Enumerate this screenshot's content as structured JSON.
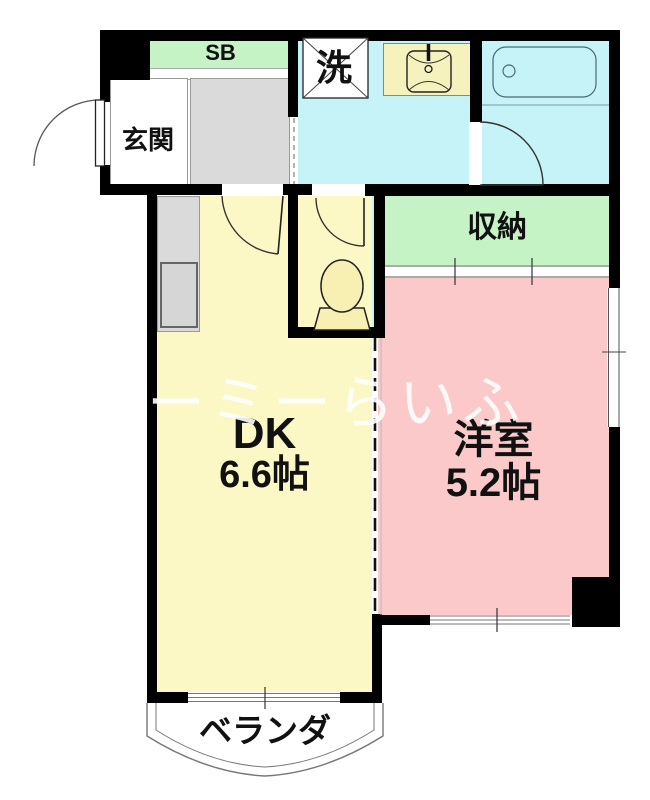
{
  "colors": {
    "wall": "#000000",
    "yellow": "#FBF8C5",
    "pink": "#FBC9C9",
    "cyan": "#C6F3F8",
    "green": "#C6F3C6",
    "gray": "#DADADA",
    "vanity": "#F6F2BE",
    "fixture": "#F8EFB3"
  },
  "rooms": {
    "shoe_box": {
      "label": "SB"
    },
    "entrance": {
      "label": "玄関"
    },
    "laundry": {
      "label": "洗"
    },
    "storage": {
      "label": "収納"
    },
    "dining_kitchen": {
      "label": "DK",
      "size": "6.6帖"
    },
    "western_room": {
      "label": "洋室",
      "size": "5.2帖"
    },
    "veranda": {
      "label": "ベランダ"
    }
  },
  "watermark": {
    "text": "ユーミーらいふ"
  }
}
